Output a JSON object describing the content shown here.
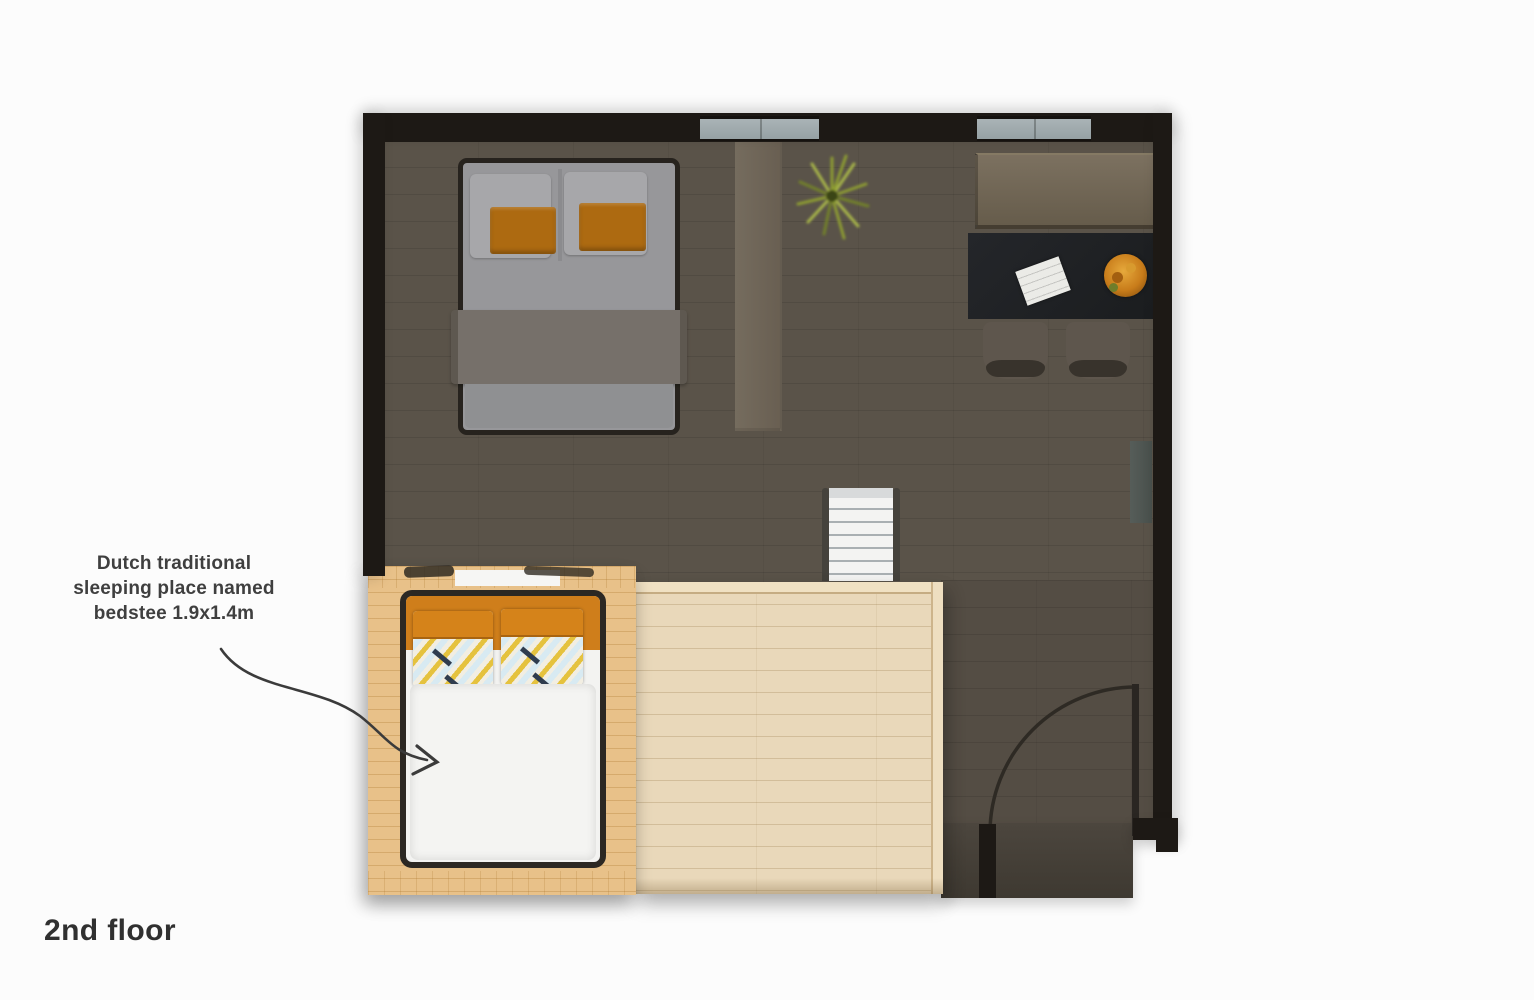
{
  "floor_label": "2nd floor",
  "annotation": {
    "line1": "Dutch traditional",
    "line2": "sleeping place named",
    "line3": "bedstee 1.9x1.4m",
    "full": "Dutch traditional sleeping place named bedstee 1.9x1.4m",
    "bedstee_size": "1.9x1.4m"
  },
  "objects": [
    "double-bed",
    "orange-cushions",
    "gray-blanket",
    "bedstee-bed",
    "bedstee-wood-box",
    "stairs",
    "wood-platform",
    "desk",
    "paper-sheet",
    "fruit-bowl",
    "desk-chairs",
    "counter",
    "plant",
    "door",
    "door-swing-arc",
    "window",
    "radiator",
    "support-beam"
  ],
  "colors": {
    "bg": "#fcfcfc",
    "wall": "#1d1915",
    "floor": "#5a5349",
    "floorDark": "#46403a",
    "beam": "#6f675a",
    "window": "#a3adb0",
    "counter": "#6f6452",
    "desk": "#202224",
    "chair": "#5e564d",
    "chairShadow": "#38332c",
    "paper": "#ebebe7",
    "bowl": "#c87c1a",
    "plant": "#8d9c33",
    "stairTread": "#f3f3f2",
    "stairLine": "#a9afb2",
    "stairRail": "#45423c",
    "platform": "#e9d8ba",
    "platformTrim": "#f0e1c3",
    "box": "#e8c189",
    "boxLine": "#c49a58",
    "bedFrame": "#27231e",
    "mattress": "#97979a",
    "blanket": "#76706a",
    "pillowGray": "#a7a7aa",
    "cushion": "#ad6a11",
    "duvet": "#f3f3f1",
    "bedsteeOrange": "#cf7e1b",
    "pillowBlue": "#d8eaf2",
    "pillowYellow": "#e5c23e",
    "accentNavy": "#2f3c4e",
    "arrow": "#3b3b3b",
    "text": "#3f3f3f"
  }
}
